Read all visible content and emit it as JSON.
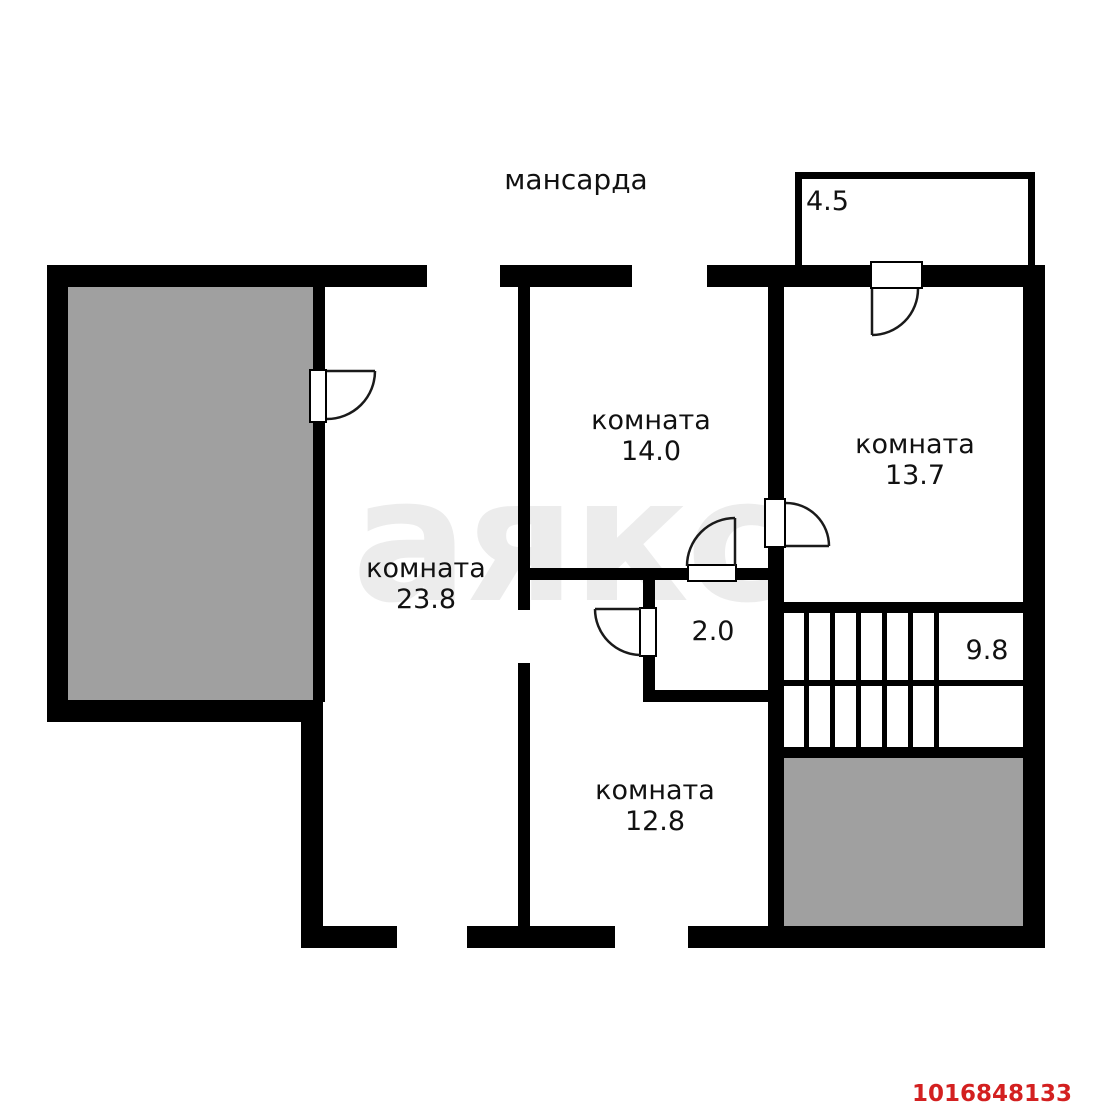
{
  "floor_title": "мансарда",
  "watermark_text": "аякс",
  "listing_id": "1016848133",
  "rooms": [
    {
      "label": "комната",
      "area": "23.8"
    },
    {
      "label": "комната",
      "area": "14.0"
    },
    {
      "label": "комната",
      "area": "13.7"
    },
    {
      "label": "комната",
      "area": "12.8"
    }
  ],
  "spaces": {
    "balcony_area": "4.5",
    "hall_area": "2.0",
    "stairs_area": "9.8"
  },
  "colors": {
    "wall": "#000000",
    "terrace_fill": "#a0a0a0",
    "watermark": "#ececec",
    "listing_id_color": "#d32020"
  }
}
